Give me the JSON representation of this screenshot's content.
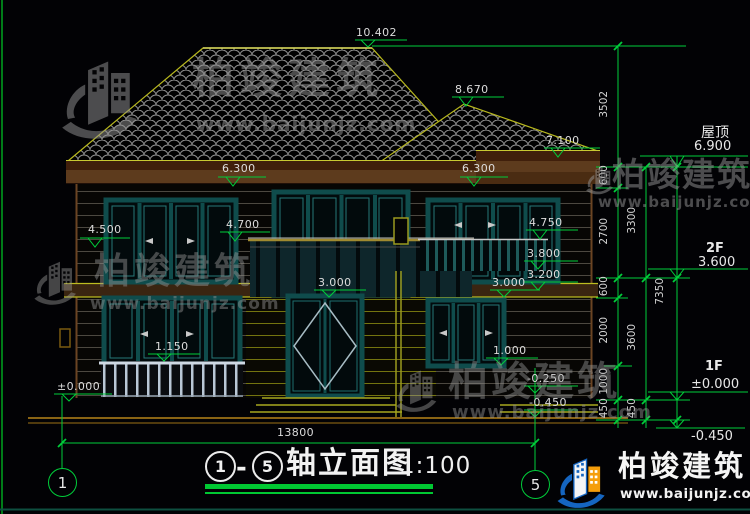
{
  "drawing": {
    "levels": {
      "peak": "10.402",
      "roof_break": "8.670",
      "right_eave": "7.100",
      "left_eave": "6.300",
      "right_eave2": "6.300",
      "left_4500": "4.500",
      "left_4700": "4.700",
      "right_4750": "4.750",
      "right_3800": "3.800",
      "right_3200": "3.200",
      "door_top": "3.000",
      "right_3000": "3.000",
      "sill_left": "1.150",
      "sill_right": "1.000",
      "ground_zero": "±0.000",
      "step_minus_250": "-0.250",
      "step_minus_450": "-0.450"
    },
    "right_panel": {
      "roof_label": "屋顶",
      "roof_level": "6.900",
      "floor2_label": "2F",
      "floor2_level": "3.600",
      "floor1_label": "1F",
      "floor1_level": "±0.000",
      "ground_level": "-0.450",
      "chain_outer": [
        "3502",
        "600",
        "2700",
        "600",
        "2000",
        "1000",
        "450"
      ],
      "chain_mid": [
        "3300",
        "3600",
        "450"
      ],
      "chain_total": "7350"
    },
    "bottom": {
      "total_width": "13800",
      "axis_start": "1",
      "axis_end": "5"
    }
  },
  "title_block": {
    "axis_start": "1",
    "separator": "-",
    "axis_end": "5",
    "name": "轴立面图",
    "scale": "1:100"
  },
  "watermark": {
    "brand": "柏竣建筑",
    "url": "www.baijunjz.com"
  },
  "colors": {
    "dimension_green": "#00cd3a",
    "roof_outline_yellow": "#b8b81e",
    "wall_brown": "#5d3b1d",
    "window_teal": "#0f4c4c",
    "logo_blue": "#1565c0",
    "logo_orange": "#f59e0b"
  }
}
